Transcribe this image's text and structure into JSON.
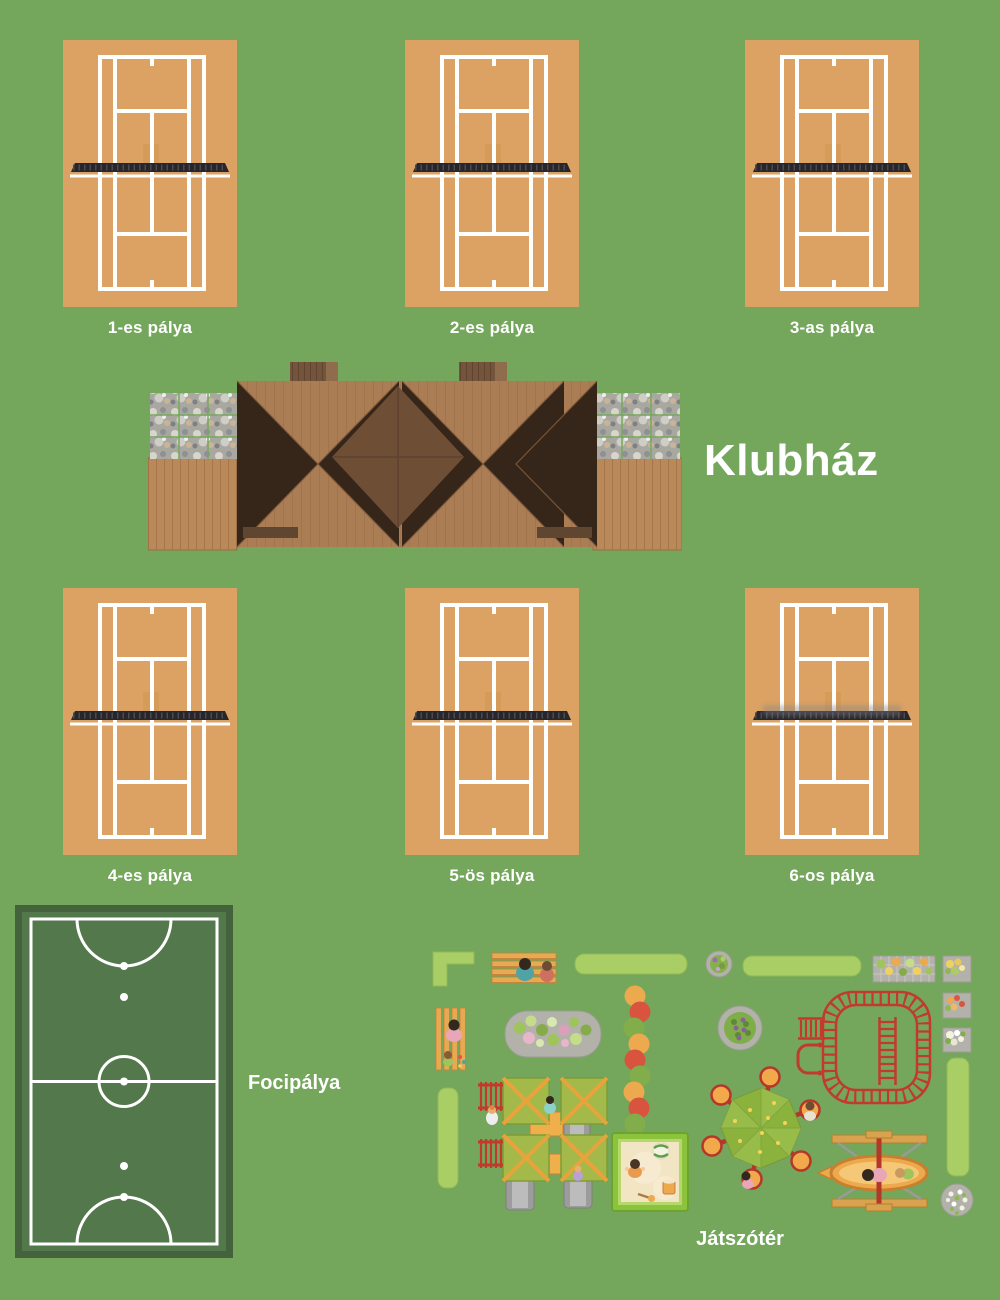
{
  "labels": {
    "clubhouse": "Klubház",
    "football_field": "Focipálya",
    "playground": "Játszótér"
  },
  "courts": [
    {
      "label": "1-es pálya"
    },
    {
      "label": "2-es pálya"
    },
    {
      "label": "3-as pálya"
    },
    {
      "label": "4-es pálya"
    },
    {
      "label": "5-ös pálya"
    },
    {
      "label": "6-os pálya"
    }
  ],
  "colors": {
    "background": "#74a75c",
    "court_clay": "#dba263",
    "court_line": "#ffffff",
    "net_dark": "#26262b",
    "field_green": "#53784b",
    "field_border": "#44633d",
    "roof_light": "#ab7d55",
    "roof_dark": "#8a6140",
    "roof_diamond": "#6f4e36",
    "deck_wood": "#b9895a",
    "pebble_gray": "#a9a8a0",
    "hedge_green": "#a9ce65",
    "equipment_red": "#c13a2b",
    "equipment_orange": "#eda94e",
    "sand": "#f2e5c4",
    "label_text": "#ffffff"
  }
}
